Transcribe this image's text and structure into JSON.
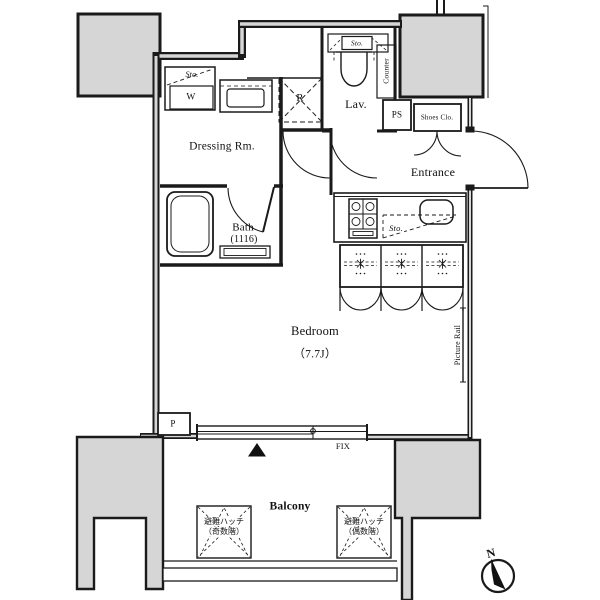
{
  "plan": {
    "rooms": {
      "dressing": "Dressing Rm.",
      "bath_line1": "Bath",
      "bath_line2": "(1116)",
      "lav": "Lav.",
      "entrance": "Entrance",
      "bedroom": "Bedroom",
      "bedroom_size": "（7.7J）",
      "balcony": "Balcony"
    },
    "labels": {
      "sto": "Sto.",
      "washer": "W",
      "refrigerator": "R",
      "ps": "PS",
      "shoes": "Shoes Clo.",
      "counter": "Counter",
      "picture_rail": "Picture Rail",
      "pipe": "P",
      "fix": "FIX",
      "north": "N"
    },
    "hatch": {
      "odd_line1": "避難ハッチ",
      "odd_line2": "（奇数階）",
      "even_line1": "避難ハッチ",
      "even_line2": "（偶数階）"
    },
    "colors": {
      "wall": "#1a1a1a",
      "pillar_fill": "#d6d6d6",
      "bg": "#ffffff"
    }
  }
}
